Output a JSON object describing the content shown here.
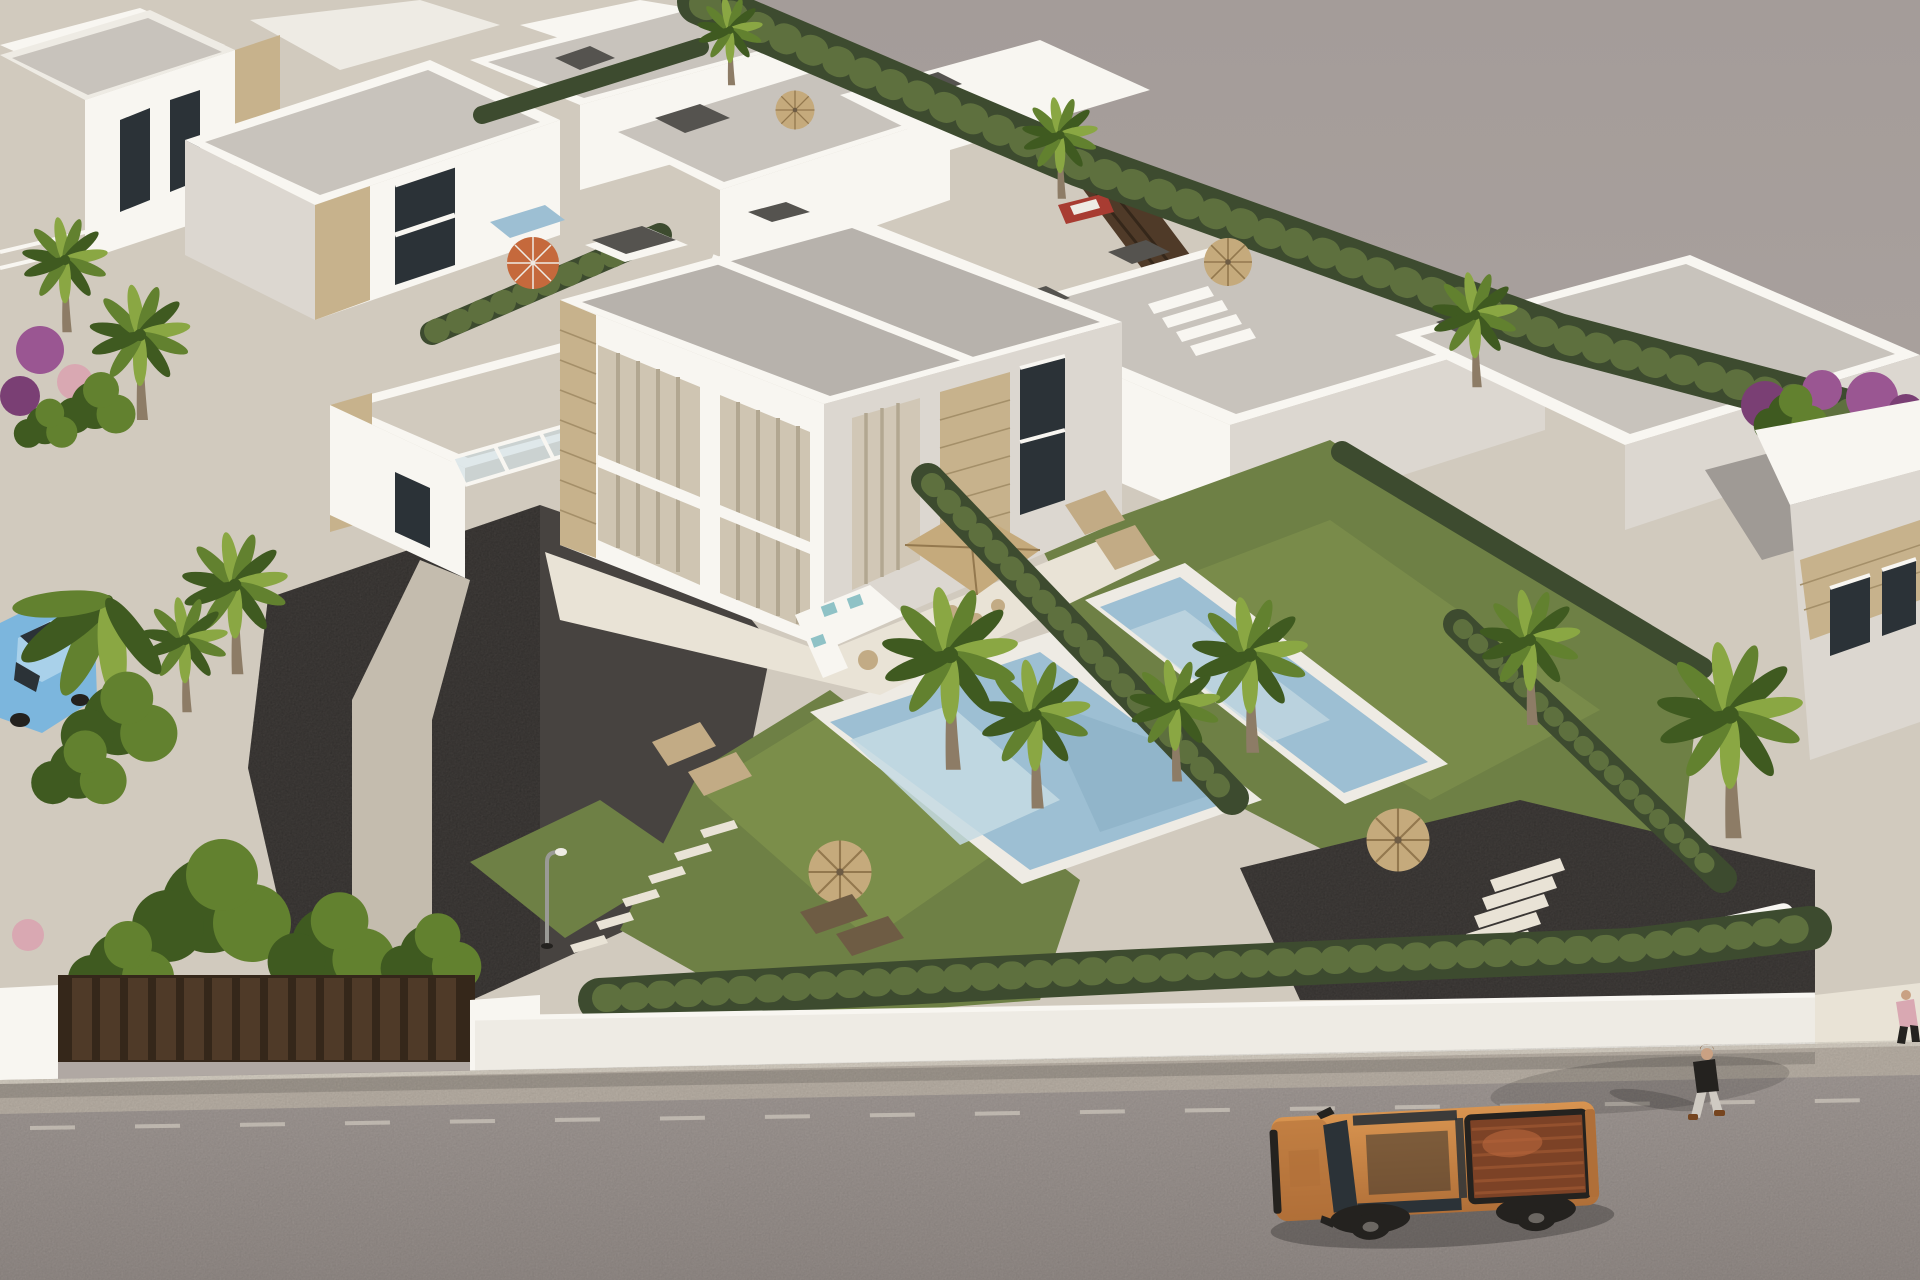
{
  "scene": {
    "type": "3d-architectural-render",
    "description": "Aerial 3D architectural rendering of a modern residential development: rows of white flat-roofed villas with stone-clad accents, a central two-story duplex villa with glass facade, private mosaic pools, lawns, dark gravel courtyards, palm trees and hedges, a white perimeter wall with brown gates, and a street below with an orange pickup truck and pedestrians. Empty gray land extends to the upper right.",
    "objects": [
      "white villa row upper-left",
      "central duplex villa",
      "glass facade with curtains",
      "stone-clad pillars",
      "flat gray roofs with chimneys",
      "roof terrace with balcony rail",
      "main swimming pool",
      "second swimming pool",
      "lawns",
      "gravel courtyard",
      "stepping stones",
      "street lamp",
      "outdoor corner sofa",
      "square dining parasol",
      "sun loungers",
      "thatched straw parasols",
      "orange parasol",
      "boundary hedges",
      "palm trees",
      "banana plants",
      "bougainvillea",
      "perimeter wall",
      "brown gate panels",
      "sidewalk",
      "asphalt road with lane dashes",
      "orange pickup truck",
      "pedestrian walking",
      "partial pedestrian at edge",
      "light blue car",
      "red car",
      "parked white car",
      "vacant gray land"
    ]
  },
  "colors": {
    "vacant_top": "#a49c99",
    "vacant_bottom": "#b2aaa5",
    "concrete": "#d1cabe",
    "concrete_bright": "#e9e3d6",
    "path_light": "#c4bcae",
    "white": "#f8f6f1",
    "white_dim": "#eeebe4",
    "shade": "#dcd7d0",
    "shade2": "#c8c3bc",
    "roof_gray": "#b7b2ac",
    "roof_dark": "#9f9a95",
    "stone": "#c7b28c",
    "stone_dark": "#a48f69",
    "cap_dark": "#55534f",
    "hedge": "#3d4b2f",
    "hedge_light": "#5e703e",
    "grass": "#6e8045",
    "grass_light": "#87994f",
    "gravel": "#474340",
    "pool": "#9dbfd3",
    "pool_light": "#c6dae3",
    "pool_deep": "#86abc1",
    "trunk": "#8d7c66",
    "palm_dark": "#3f5a20",
    "palm_mid": "#62812f",
    "palm_light": "#8aa743",
    "straw": "#c5aa7c",
    "straw_line": "#93784e",
    "orange": "#c5693c",
    "road": "#a59d99",
    "road_dark": "#968e8a",
    "sidewalk": "#bdb4a9",
    "curb": "#d9d2c6",
    "gate_brown": "#4f3a28",
    "gate_brown_dark": "#35271a",
    "truck_body": "#d89450",
    "truck_dark": "#b06f38",
    "truck_bed": "#7c4226",
    "truck_bed_rib": "#94512e",
    "black": "#24221f",
    "glass": "#2b3237",
    "curtain": "#cfc5b2",
    "curtain_dark": "#b2a791",
    "teal": "#8fc2c6",
    "tan": "#c2ab85",
    "tan_dark": "#6e5c44",
    "car_blue": "#7cb6dd",
    "car_blue_light": "#a9d1ea",
    "car_red": "#a83c32",
    "pink": "#d9a8b2",
    "skin": "#c9a183",
    "hair": "#76451f",
    "purple": "#9a5692",
    "purple_dark": "#7a3f74",
    "lamp_gray": "#9a9a96",
    "shadow": "rgba(0,0,0,0.25)",
    "shadow_soft": "rgba(0,0,0,0.14)"
  }
}
